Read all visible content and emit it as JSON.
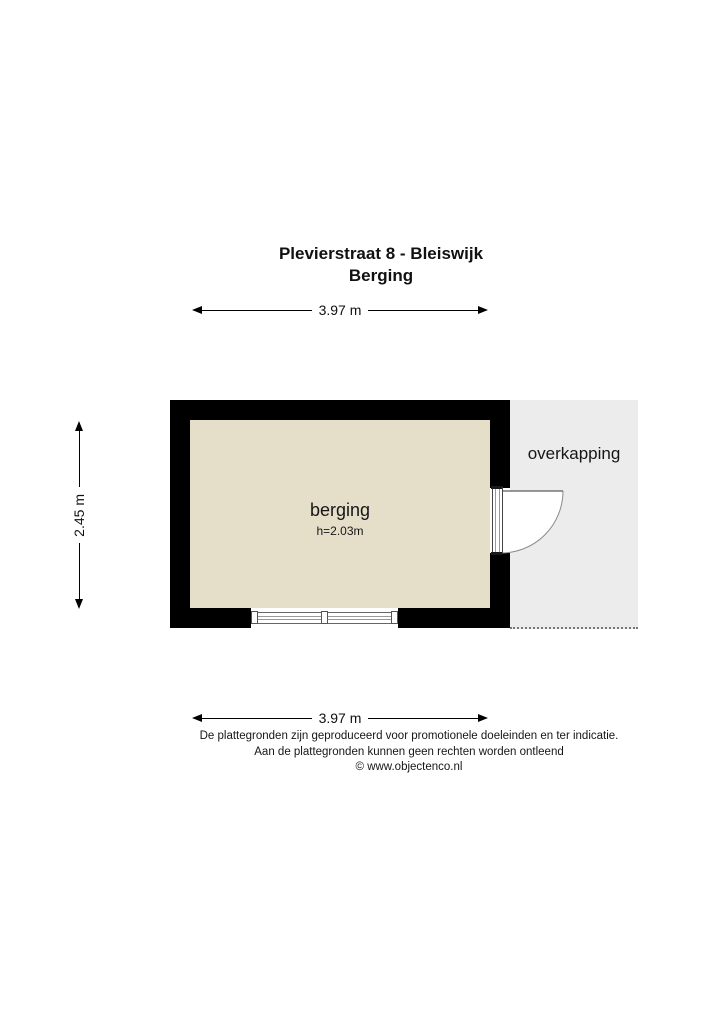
{
  "header": {
    "title": "Plevierstraat 8 - Bleiswijk",
    "subtitle": "Berging"
  },
  "dimensions": {
    "top": "3.97 m",
    "side": "2.45 m",
    "bottom": "3.97 m"
  },
  "plan": {
    "room": {
      "label": "berging",
      "ceiling_height": "h=2.03m"
    },
    "overkapping": {
      "label": "overkapping"
    }
  },
  "footer": {
    "line1": "De plattegronden zijn geproduceerd voor promotionele doeleinden en ter indicatie.",
    "line2": "Aan de plattegronden kunnen geen rechten worden ontleend",
    "line3": "© www.objectenco.nl"
  },
  "colors": {
    "wall": "#000000",
    "room_fill": "#e5dfca",
    "overkapping_fill": "#ececec"
  }
}
